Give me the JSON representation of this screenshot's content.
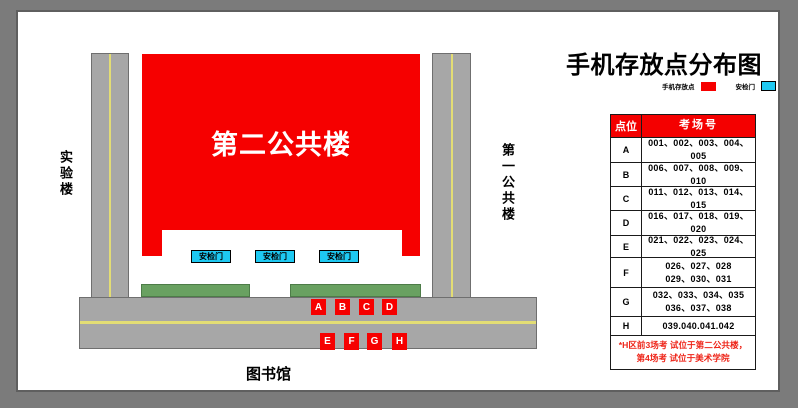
{
  "title": "手机存放点分布图",
  "legend": {
    "items": [
      {
        "label": "手机存放点",
        "color": "#f60000"
      },
      {
        "label": "安检门",
        "color": "#1ec9f2"
      }
    ]
  },
  "map": {
    "building_main": "第二公共楼",
    "building_left": "实验楼",
    "building_right": "第一公共楼",
    "building_bottom": "图书馆",
    "gate_label": "安检门",
    "points_top": [
      "A",
      "B",
      "C",
      "D"
    ],
    "points_bottom": [
      "E",
      "F",
      "G",
      "H"
    ]
  },
  "table": {
    "headers": {
      "point": "点位",
      "rooms": "考场号"
    },
    "rows": [
      {
        "point": "A",
        "rooms": "001、002、003、004、005"
      },
      {
        "point": "B",
        "rooms": "006、007、008、009、010"
      },
      {
        "point": "C",
        "rooms": "011、012、013、014、015"
      },
      {
        "point": "D",
        "rooms": "016、017、018、019、020"
      },
      {
        "point": "E",
        "rooms": "021、022、023、024、025"
      },
      {
        "point": "F",
        "rooms": "026、027、028\n029、030、031"
      },
      {
        "point": "G",
        "rooms": "032、033、034、035\n036、037、038"
      },
      {
        "point": "H",
        "rooms": "039.040.041.042"
      }
    ],
    "footnote": "*H区前3场考 试位于第二公共楼，\n第4场考 试位于美术学院"
  },
  "colors": {
    "building_red": "#f60000",
    "gate_cyan": "#1ec9f2",
    "road_gray": "#a7a7a7",
    "lane_yellow": "#e3dd74",
    "hedge_green": "#69a161",
    "frame_gray": "#7b7b7b",
    "footnote_red": "#ee2418"
  }
}
